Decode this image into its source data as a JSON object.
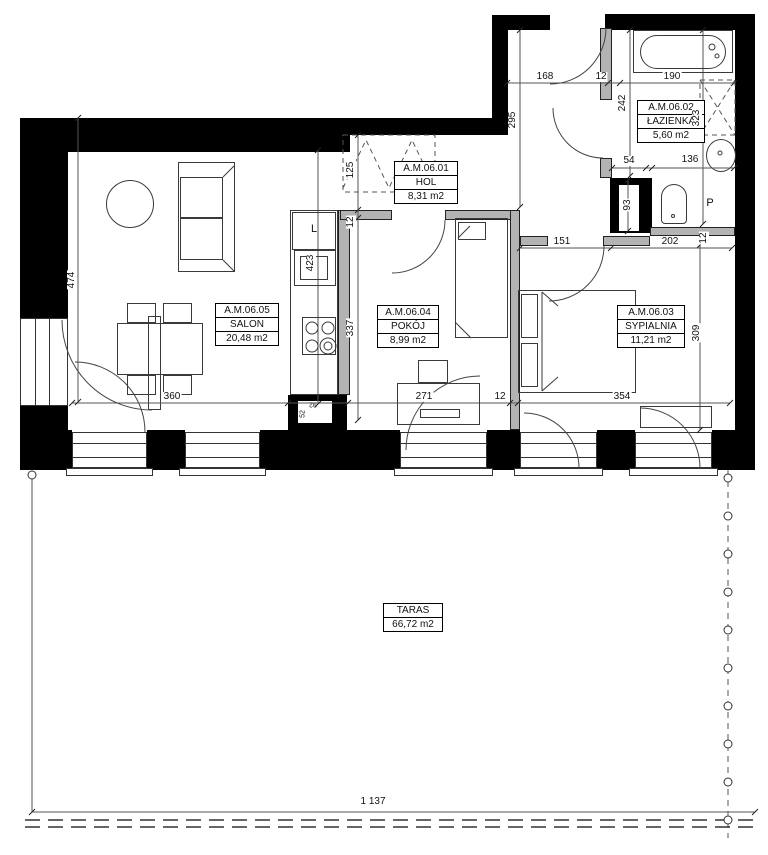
{
  "rooms": {
    "hol": {
      "id": "A.M.06.01",
      "name": "HOL",
      "area": "8,31 m2"
    },
    "lazienka": {
      "id": "A.M.06.02",
      "name": "ŁAZIENKA",
      "area": "5,60 m2"
    },
    "sypialnia": {
      "id": "A.M.06.03",
      "name": "SYPIALNIA",
      "area": "11,21 m2"
    },
    "pokoj": {
      "id": "A.M.06.04",
      "name": "POKÓJ",
      "area": "8,99 m2"
    },
    "salon": {
      "id": "A.M.06.05",
      "name": "SALON",
      "area": "20,48 m2"
    },
    "taras": {
      "name": "TARAS",
      "area": "66,72 m2"
    }
  },
  "dims": {
    "d168": "168",
    "d12_top": "12",
    "d190": "190",
    "d295": "295",
    "d242": "242",
    "d323": "323",
    "d54": "54",
    "d136": "136",
    "d93": "93",
    "d151": "151",
    "d202": "202",
    "d12_wc": "12",
    "d125": "125",
    "d12_kitchen": "12",
    "d423": "423",
    "d337": "337",
    "d474": "474",
    "d360": "360",
    "d271": "271",
    "d12_mid": "12",
    "d354": "354",
    "d309": "309",
    "d92": "92",
    "d52": "52",
    "total": "1 137"
  },
  "annotations": {
    "fridge": "L",
    "shaft": "P"
  },
  "colors": {
    "wall": "#000000",
    "partition": "#b3b3b3",
    "line": "#444444",
    "background": "#ffffff"
  }
}
